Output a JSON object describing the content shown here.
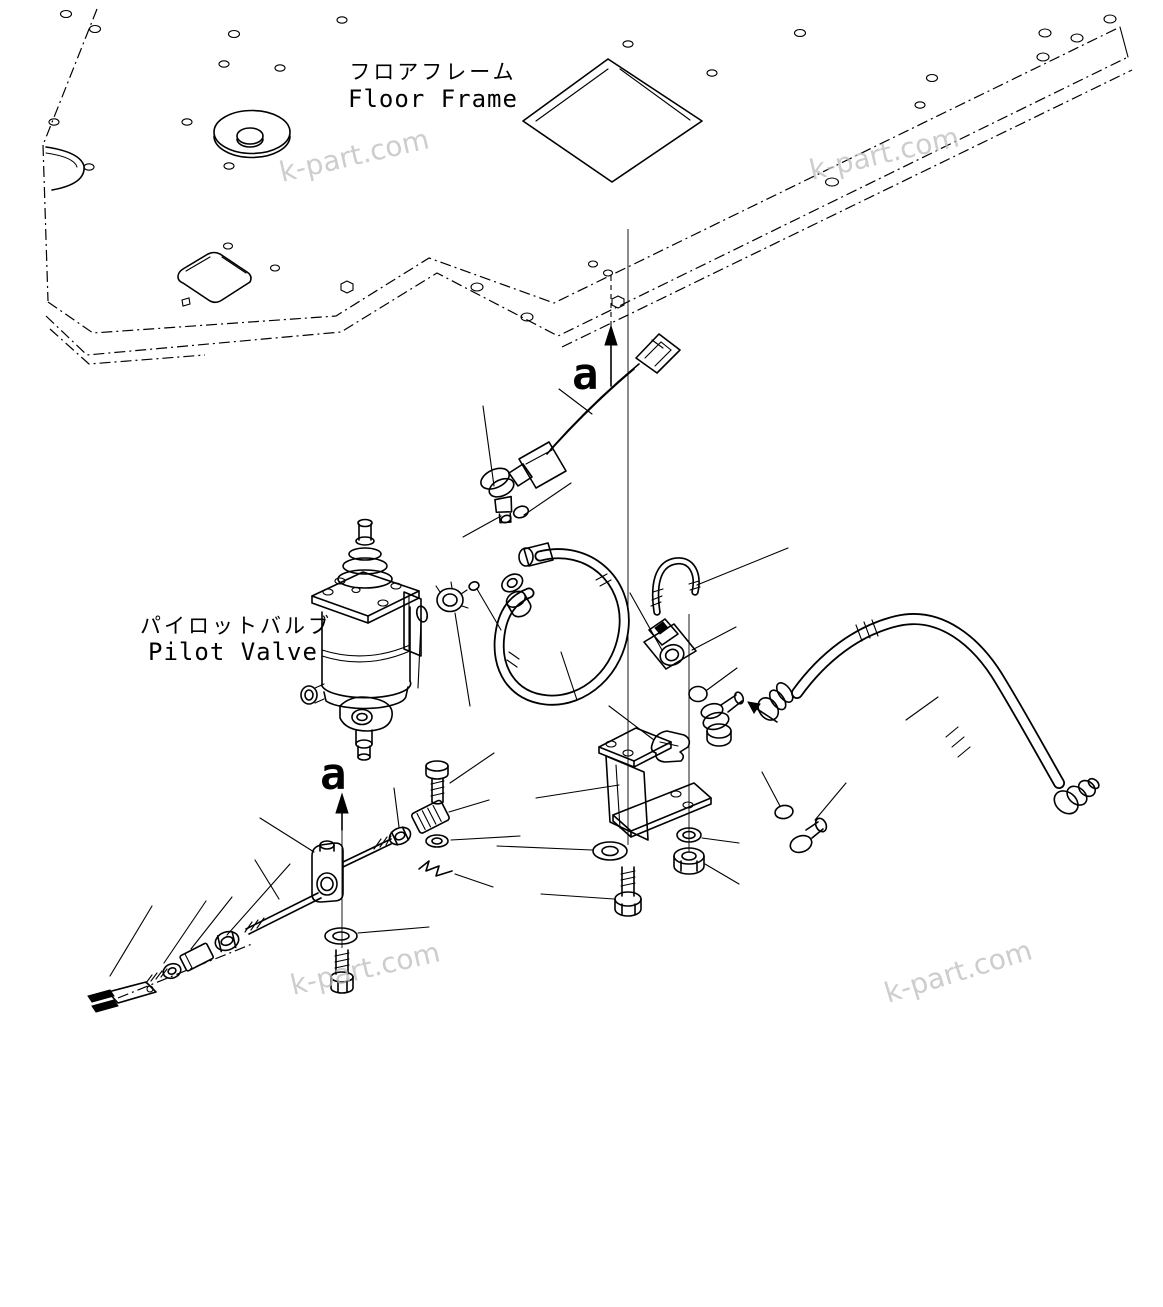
{
  "diagram": {
    "labels": {
      "floor_frame_jp": "フロアフレーム",
      "floor_frame_en": "Floor Frame",
      "pilot_valve_jp": "パイロットバルブ",
      "pilot_valve_en": "Pilot Valve",
      "detail_marker_upper": "a",
      "detail_marker_lower": "a"
    },
    "watermark": {
      "text": "k-part.com",
      "color": "#bdbdbd"
    },
    "colors": {
      "line": "#000000",
      "background": "#ffffff"
    }
  }
}
